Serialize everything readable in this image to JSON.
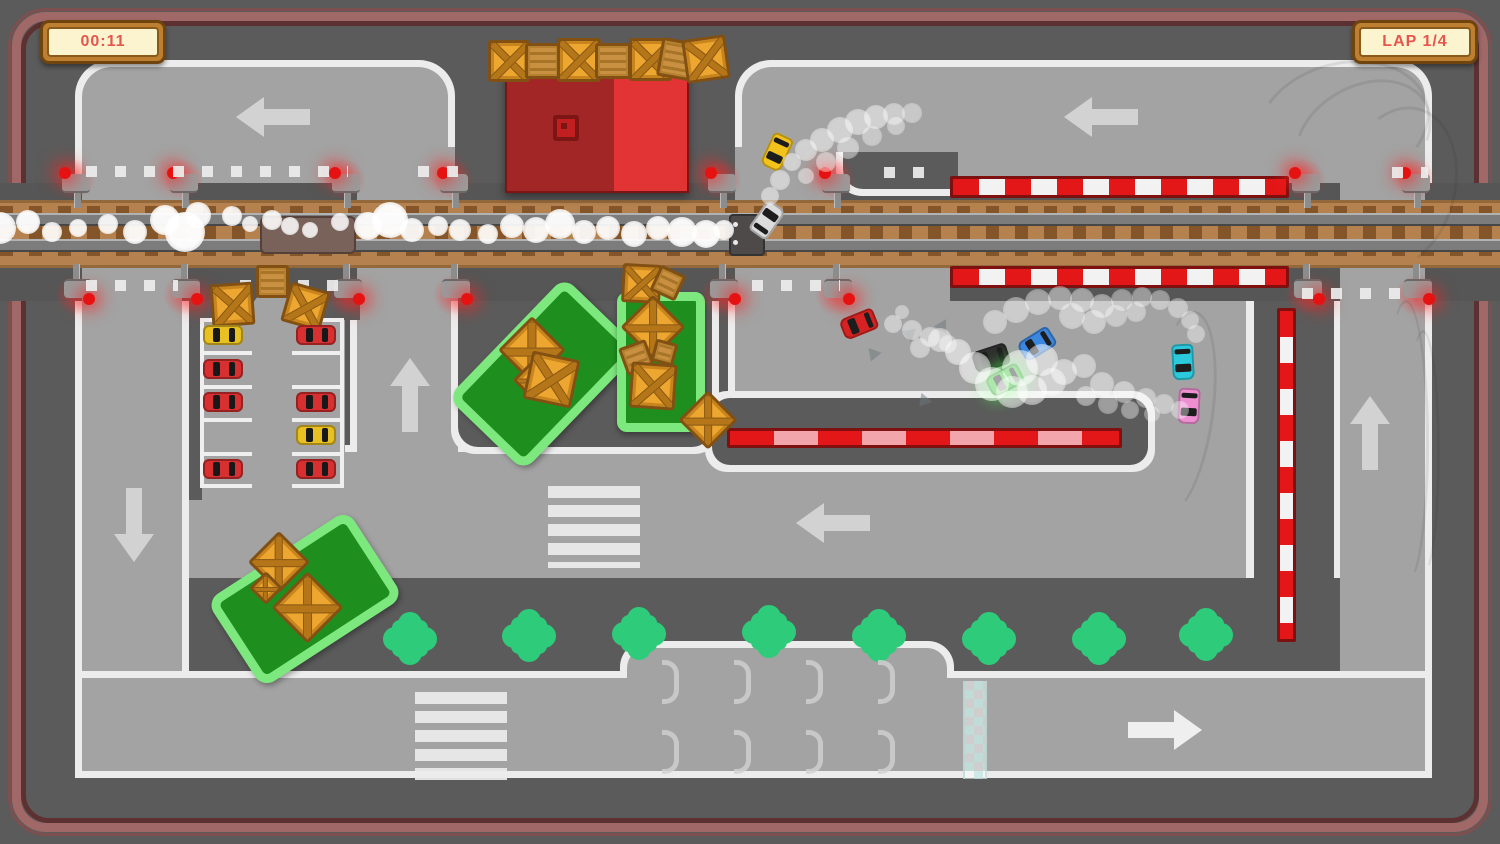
{
  "hud": {
    "timer": "00:11",
    "lap": "LAP 1/4"
  },
  "colors": {
    "bg": "#5b5b5b",
    "road": "#a3a3a3",
    "line": "#ececec",
    "wall_outer": "#a16868",
    "wall_inner": "#5d3131",
    "gravel": "#b5824f",
    "barrier_red": "#e31717",
    "barrier_pink": "#f2a6ac",
    "grass": "#1e8f1e",
    "grassb": "#7de87d",
    "tree": "#2ecc7a",
    "crate": "#eda62f",
    "building_dark": "#a32626",
    "building_bright": "#e23434",
    "hud_text": "#e4564e",
    "hud_panel": "#fcf3cf",
    "hud_frame": "#bd8030"
  },
  "scene": {
    "racers": [
      {
        "x": 766,
        "y": 134,
        "rot": 205,
        "c": "#f2c21d",
        "name": "yellow-race-car"
      },
      {
        "x": 756,
        "y": 202,
        "rot": 35,
        "c": "#dcdcdc",
        "name": "white-race-car"
      },
      {
        "x": 848,
        "y": 306,
        "rot": 248,
        "c": "#d62222",
        "name": "red-race-car"
      },
      {
        "x": 980,
        "y": 340,
        "rot": 252,
        "c": "#2f2f2f",
        "name": "black-race-car"
      },
      {
        "x": 994,
        "y": 362,
        "rot": 242,
        "c": "#2fc52f",
        "glow": true,
        "name": "green-race-car"
      },
      {
        "x": 1026,
        "y": 326,
        "rot": 238,
        "c": "#3b87e0",
        "name": "blue-race-car"
      },
      {
        "x": 1172,
        "y": 344,
        "rot": 177,
        "c": "#2cc9dc",
        "name": "cyan-race-car"
      },
      {
        "x": 1178,
        "y": 388,
        "rot": 183,
        "c": "#ee8fd2",
        "name": "pink-race-car"
      }
    ],
    "parked_cars": [
      {
        "x": 203,
        "y": 325,
        "c": "#e8c021"
      },
      {
        "x": 296,
        "y": 325,
        "c": "#d83030"
      },
      {
        "x": 203,
        "y": 359,
        "c": "#d83030"
      },
      {
        "x": 203,
        "y": 392,
        "c": "#d83030"
      },
      {
        "x": 296,
        "y": 392,
        "c": "#d83030"
      },
      {
        "x": 296,
        "y": 425,
        "c": "#e8c021"
      },
      {
        "x": 203,
        "y": 459,
        "c": "#d83030"
      },
      {
        "x": 296,
        "y": 459,
        "c": "#d83030"
      }
    ],
    "crates": [
      [
        488,
        40,
        36,
        0,
        "x"
      ],
      [
        525,
        43,
        30,
        0,
        "p"
      ],
      [
        557,
        38,
        38,
        0,
        "x"
      ],
      [
        595,
        43,
        30,
        0,
        "p"
      ],
      [
        629,
        38,
        37,
        0,
        "x"
      ],
      [
        659,
        40,
        33,
        10,
        "p"
      ],
      [
        684,
        37,
        38,
        -8,
        "x"
      ],
      [
        211,
        283,
        37,
        -4,
        "x"
      ],
      [
        256,
        265,
        27,
        0,
        "p"
      ],
      [
        285,
        286,
        35,
        16,
        "x"
      ],
      [
        622,
        264,
        33,
        3,
        "x"
      ],
      [
        654,
        269,
        22,
        25,
        "p"
      ],
      [
        508,
        326,
        42,
        45,
        "x"
      ],
      [
        518,
        367,
        20,
        45,
        "x"
      ],
      [
        527,
        355,
        43,
        12,
        "x"
      ],
      [
        630,
        304,
        40,
        45,
        "x"
      ],
      [
        622,
        343,
        23,
        -20,
        "p"
      ],
      [
        653,
        341,
        17,
        15,
        "p"
      ],
      [
        630,
        363,
        40,
        4,
        "x"
      ],
      [
        687,
        399,
        36,
        45,
        "x"
      ],
      [
        257,
        540,
        38,
        45,
        "x"
      ],
      [
        254,
        576,
        18,
        45,
        "x"
      ],
      [
        282,
        582,
        45,
        45,
        "x"
      ]
    ],
    "trees": [
      [
        395,
        624
      ],
      [
        514,
        621
      ],
      [
        624,
        619
      ],
      [
        754,
        617
      ],
      [
        864,
        621
      ],
      [
        974,
        624
      ],
      [
        1084,
        624
      ],
      [
        1191,
        620
      ]
    ],
    "arrows": [
      {
        "x": 230,
        "y": 97,
        "r": 0
      },
      {
        "x": 1058,
        "y": 97,
        "r": 0
      },
      {
        "x": 364,
        "y": 378,
        "r": 90
      },
      {
        "x": 88,
        "y": 502,
        "r": -90
      },
      {
        "x": 790,
        "y": 503,
        "r": 0
      },
      {
        "x": 1324,
        "y": 416,
        "r": 90
      },
      {
        "x": 1116,
        "y": 710,
        "r": 180,
        "b": 1
      }
    ],
    "posts_x": [
      62,
      170,
      332,
      440,
      708,
      822,
      1292,
      1402
    ],
    "dots": [
      [
        86,
        166,
        262
      ],
      [
        418,
        166,
        58
      ],
      [
        884,
        167,
        56
      ],
      [
        1392,
        167,
        36
      ],
      [
        86,
        280,
        92
      ],
      [
        240,
        280,
        106
      ],
      [
        752,
        280,
        88
      ],
      [
        1302,
        288,
        116
      ]
    ],
    "brackets": [
      [
        662,
        660
      ],
      [
        734,
        660
      ],
      [
        806,
        660
      ],
      [
        878,
        660
      ],
      [
        662,
        730
      ],
      [
        734,
        730
      ],
      [
        806,
        730
      ],
      [
        878,
        730
      ]
    ],
    "skids": [
      [
        1255,
        62,
        170,
        120,
        -15
      ],
      [
        1290,
        85,
        140,
        100,
        -30
      ],
      [
        1340,
        105,
        110,
        160,
        15
      ],
      [
        1383,
        300,
        40,
        280,
        0
      ],
      [
        1406,
        330,
        28,
        240,
        0
      ],
      [
        1148,
        310,
        60,
        200,
        8
      ]
    ],
    "tris": [
      [
        866,
        350,
        200
      ],
      [
        903,
        330,
        170
      ],
      [
        936,
        322,
        150
      ],
      [
        916,
        396,
        220
      ]
    ],
    "puffs": [
      [
        0,
        228,
        16,
        0.95
      ],
      [
        28,
        222,
        12,
        0.95
      ],
      [
        52,
        232,
        10,
        0.9
      ],
      [
        78,
        228,
        9,
        0.9
      ],
      [
        108,
        224,
        10,
        0.9
      ],
      [
        135,
        232,
        12,
        0.92
      ],
      [
        165,
        220,
        15,
        0.95
      ],
      [
        185,
        232,
        20,
        0.97
      ],
      [
        198,
        215,
        13,
        0.92
      ],
      [
        232,
        216,
        10,
        0.9
      ],
      [
        250,
        224,
        8,
        0.85
      ],
      [
        272,
        220,
        10,
        0.88
      ],
      [
        290,
        226,
        9,
        0.85
      ],
      [
        310,
        230,
        8,
        0.85
      ],
      [
        340,
        222,
        9,
        0.85
      ],
      [
        368,
        226,
        14,
        0.95
      ],
      [
        390,
        220,
        18,
        0.97
      ],
      [
        412,
        230,
        12,
        0.92
      ],
      [
        438,
        226,
        10,
        0.9
      ],
      [
        460,
        230,
        11,
        0.9
      ],
      [
        488,
        234,
        10,
        0.9
      ],
      [
        512,
        226,
        12,
        0.92
      ],
      [
        536,
        230,
        13,
        0.92
      ],
      [
        560,
        224,
        15,
        0.95
      ],
      [
        584,
        232,
        12,
        0.92
      ],
      [
        608,
        228,
        12,
        0.92
      ],
      [
        634,
        234,
        13,
        0.92
      ],
      [
        658,
        228,
        12,
        0.92
      ],
      [
        682,
        232,
        15,
        0.95
      ],
      [
        706,
        234,
        14,
        0.95
      ],
      [
        724,
        230,
        10,
        0.9
      ],
      [
        792,
        162,
        9,
        0.5
      ],
      [
        806,
        150,
        11,
        0.5
      ],
      [
        822,
        140,
        12,
        0.5
      ],
      [
        840,
        130,
        13,
        0.5
      ],
      [
        858,
        122,
        13,
        0.5
      ],
      [
        876,
        117,
        12,
        0.5
      ],
      [
        894,
        114,
        11,
        0.45
      ],
      [
        912,
        113,
        10,
        0.4
      ],
      [
        806,
        176,
        8,
        0.45
      ],
      [
        826,
        162,
        10,
        0.45
      ],
      [
        848,
        148,
        11,
        0.45
      ],
      [
        872,
        136,
        10,
        0.4
      ],
      [
        896,
        126,
        9,
        0.4
      ],
      [
        780,
        180,
        10,
        0.5
      ],
      [
        770,
        196,
        9,
        0.5
      ],
      [
        893,
        324,
        9,
        0.45
      ],
      [
        912,
        330,
        10,
        0.45
      ],
      [
        930,
        337,
        10,
        0.45
      ],
      [
        948,
        344,
        9,
        0.4
      ],
      [
        902,
        312,
        7,
        0.4
      ],
      [
        958,
        352,
        13,
        0.55
      ],
      [
        975,
        368,
        16,
        0.6
      ],
      [
        992,
        384,
        17,
        0.6
      ],
      [
        1012,
        392,
        16,
        0.55
      ],
      [
        1032,
        390,
        15,
        0.55
      ],
      [
        1052,
        382,
        14,
        0.5
      ],
      [
        1020,
        368,
        18,
        0.6
      ],
      [
        1042,
        360,
        16,
        0.55
      ],
      [
        1064,
        372,
        13,
        0.5
      ],
      [
        1084,
        366,
        12,
        0.45
      ],
      [
        995,
        322,
        12,
        0.45
      ],
      [
        1016,
        310,
        13,
        0.45
      ],
      [
        1038,
        302,
        13,
        0.45
      ],
      [
        1060,
        298,
        12,
        0.45
      ],
      [
        1082,
        300,
        12,
        0.45
      ],
      [
        1102,
        306,
        12,
        0.45
      ],
      [
        1122,
        300,
        11,
        0.4
      ],
      [
        1142,
        297,
        10,
        0.4
      ],
      [
        1160,
        300,
        10,
        0.4
      ],
      [
        1178,
        308,
        10,
        0.4
      ],
      [
        1072,
        316,
        13,
        0.45
      ],
      [
        1094,
        322,
        12,
        0.45
      ],
      [
        1116,
        316,
        11,
        0.4
      ],
      [
        1136,
        312,
        10,
        0.4
      ],
      [
        940,
        340,
        12,
        0.5
      ],
      [
        920,
        348,
        10,
        0.45
      ],
      [
        1190,
        320,
        9,
        0.4
      ],
      [
        1196,
        334,
        9,
        0.4
      ],
      [
        1102,
        384,
        12,
        0.45
      ],
      [
        1124,
        392,
        11,
        0.45
      ],
      [
        1146,
        398,
        10,
        0.4
      ],
      [
        1164,
        404,
        10,
        0.4
      ],
      [
        1180,
        410,
        9,
        0.4
      ],
      [
        1086,
        396,
        10,
        0.45
      ],
      [
        1108,
        404,
        10,
        0.4
      ],
      [
        1130,
        410,
        9,
        0.4
      ],
      [
        1152,
        414,
        8,
        0.35
      ]
    ]
  }
}
